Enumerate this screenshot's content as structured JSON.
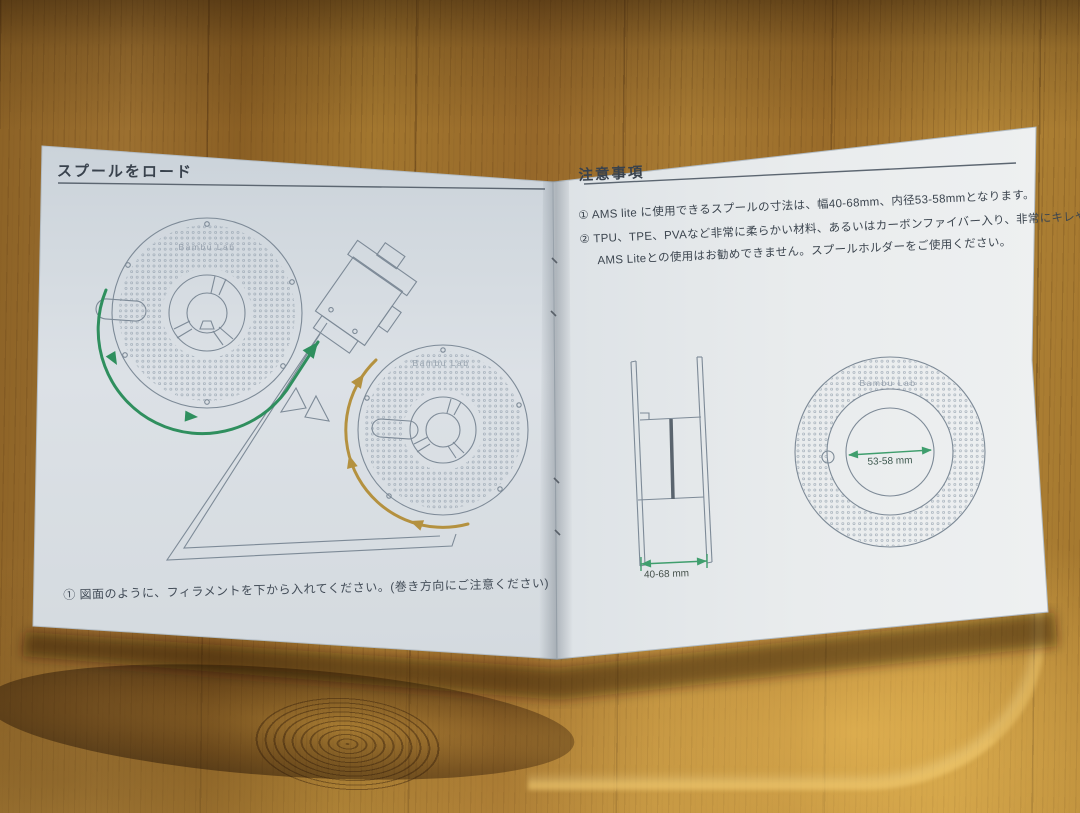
{
  "scene": {
    "description": "Open AMS Lite instruction booklet lying on a wooden table"
  },
  "left_page": {
    "heading": "スプールをロード",
    "caption": "① 図面のように、フィラメントを下から入れてください。(巻き方向にご注意ください)",
    "spool_brand": "Bambu Lab"
  },
  "right_page": {
    "heading": "注意事項",
    "note_lines": [
      "① AMS lite に使用できるスプールの寸法は、幅40-68mm、内径53-58mmとなります。",
      "② TPU、TPE、PVAなど非常に柔らかい材料、あるいはカーボンファイバー入り、非常にキレやすい材料は",
      "AMS Liteとの使用はお勧めできません。スプールホルダーをご使用ください。"
    ],
    "width_label": "40-68 mm",
    "inner_diameter_label": "53-58 mm",
    "spool_brand": "Bambu Lab"
  },
  "colors": {
    "filament_path_left_spool": "#2f8f5e",
    "filament_path_right_spool": "#b4913f",
    "dimension_arrow": "#3f9e6d",
    "page_left": "#d6dce2",
    "page_right": "#e8ebee",
    "diagram_line": "#7d8a97",
    "heading_text": "#39424d",
    "wood": "#a0742f"
  }
}
